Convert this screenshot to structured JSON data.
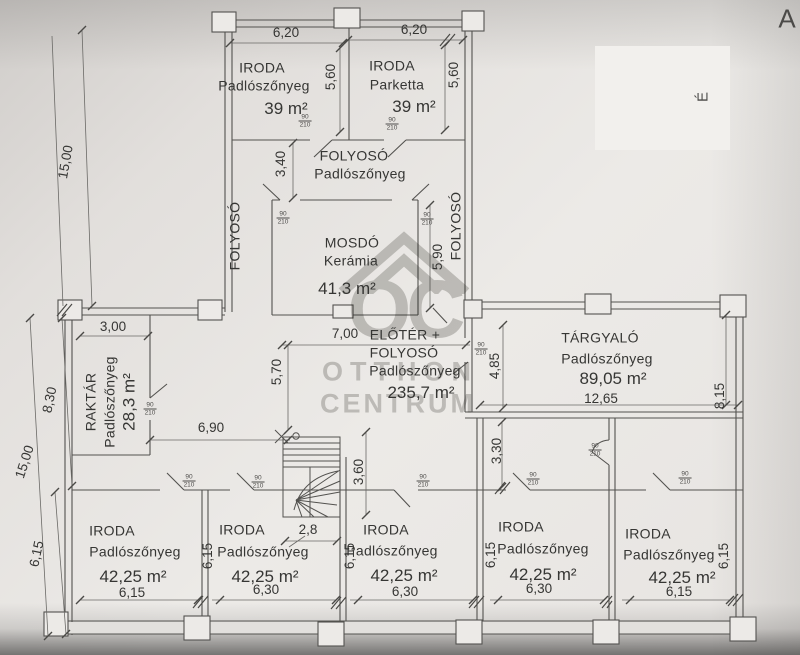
{
  "sheet": {
    "corner_letter": "A"
  },
  "compass": {
    "north": "É"
  },
  "watermark": {
    "monogram": "OC",
    "name1": "OTTHON",
    "name2": "CENTRUM"
  },
  "door": {
    "width": "90",
    "height": "210"
  },
  "rooms": {
    "iroda_nw": {
      "name": "IRODA",
      "finish": "Padlószőnyeg",
      "area": "39 m²"
    },
    "iroda_ne": {
      "name": "IRODA",
      "finish": "Parketta",
      "area": "39 m²"
    },
    "folyoso_top": {
      "name": "FOLYOSÓ",
      "finish": "Padlószőnyeg"
    },
    "folyoso_left": {
      "name": "FOLYOSÓ"
    },
    "folyoso_right": {
      "name": "FOLYOSÓ"
    },
    "mosdo": {
      "name": "MOSDÓ",
      "finish": "Kerámia",
      "area": "41,3 m²"
    },
    "eloter": {
      "name_line1": "ELŐTÉR +",
      "name_line2": "FOLYOSÓ",
      "finish": "Padlószőnyeg",
      "area": "235,7 m²"
    },
    "raktar": {
      "name": "RAKTÁR",
      "finish": "Padlószőnyeg",
      "area": "28,3 m²"
    },
    "targyalo": {
      "name": "TÁRGYALÓ",
      "finish": "Padlószőnyeg",
      "area": "89,05 m²"
    },
    "iroda_bottom": {
      "name": "IRODA",
      "finish": "Padlószőnyeg",
      "area": "42,25 m²"
    }
  },
  "dims": {
    "w620": "6,20",
    "h560": "5,60",
    "h340": "3,40",
    "h590": "5,90",
    "left15": "15,00",
    "left830": "8,30",
    "left615": "6,15",
    "raktar_w": "3,00",
    "mid_w": "6,90",
    "eloter_w": "7,00",
    "eloter_h": "5,70",
    "targyalo_left": "4,85",
    "targyalo_w": "12,65",
    "targyalo_right": "8,15",
    "stair_h": "3,60",
    "hall_h": "3,30",
    "stair_w": "2,8",
    "room615": "6,15",
    "room630": "6,30",
    "row615": "6,15"
  }
}
